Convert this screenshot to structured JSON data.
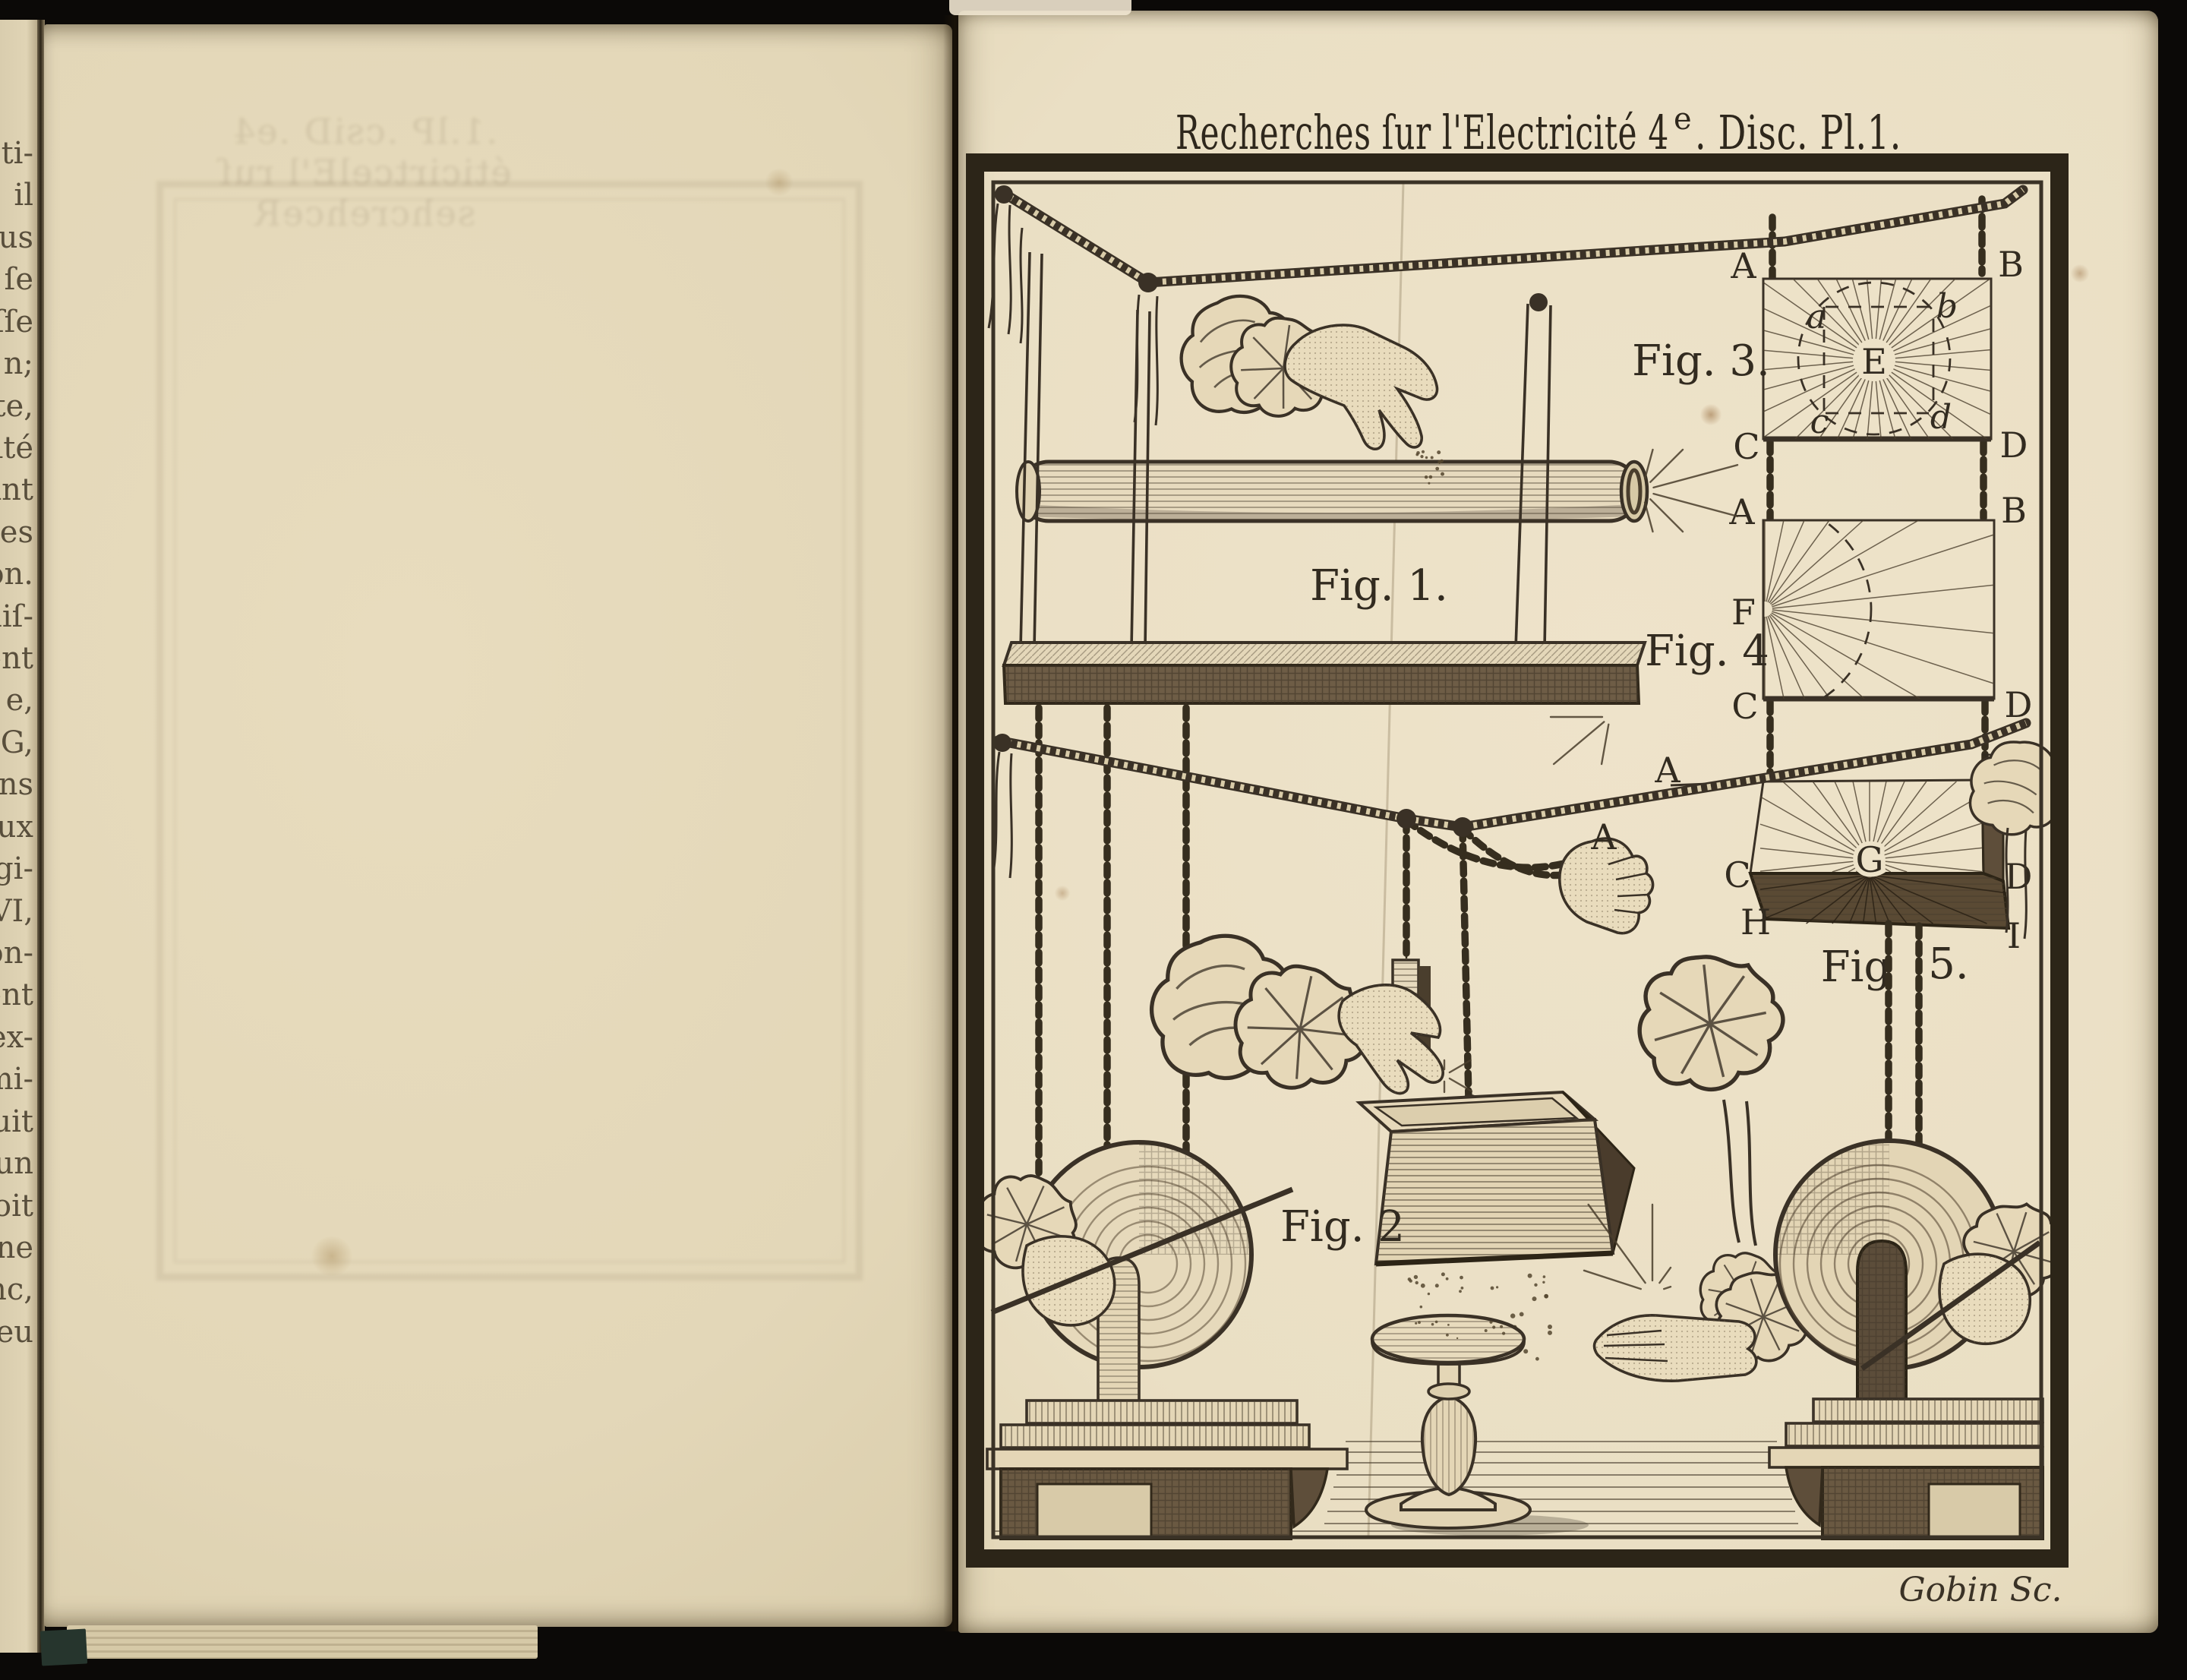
{
  "book": {
    "left_page": {
      "fragments": [
        "ti-",
        "il",
        "us",
        "ſe",
        "ſſe",
        "n;",
        "te,",
        "ité",
        "int",
        "des",
        "on.",
        "aiſ-",
        "ent",
        "e,",
        "G,",
        "ons",
        "ux",
        "gi-",
        "VI,",
        "on-",
        "ent",
        "ex-",
        "mi-",
        "uit",
        "un",
        "oit",
        "ne",
        "nc,",
        "eu"
      ],
      "show_through": ".1.lP .csiD .e4 éticirtcelE'l ruſ sehcrehceR"
    }
  },
  "plate": {
    "title": {
      "pre": "Recherches ſur l'Electricité 4",
      "sup": "e",
      "post": ". Disc. Pl.1."
    },
    "signature": "Gobin Sc.",
    "figures": {
      "fig1": {
        "label": "Fig. 1."
      },
      "fig2": {
        "label": "Fig. 2"
      },
      "fig3": {
        "label": "Fig. 3.",
        "A": "A",
        "B": "B",
        "C": "C",
        "D": "D",
        "a": "a",
        "b": "b",
        "c": "c",
        "d": "d",
        "E": "E"
      },
      "fig4": {
        "label": "Fig. 4",
        "A": "A",
        "B": "B",
        "C": "C",
        "D": "D",
        "F": "F"
      },
      "fig5": {
        "label": "Fig",
        "label2": "5.",
        "A": "A",
        "B": "B",
        "C": "C",
        "D": "D",
        "G": "G",
        "H": "H",
        "I": "I"
      },
      "hand_chain_label": "A"
    }
  },
  "colors": {
    "paper": "#e9dec4",
    "ink": "#3a3126",
    "frame": "#2c2518",
    "background": "#0b0907"
  }
}
